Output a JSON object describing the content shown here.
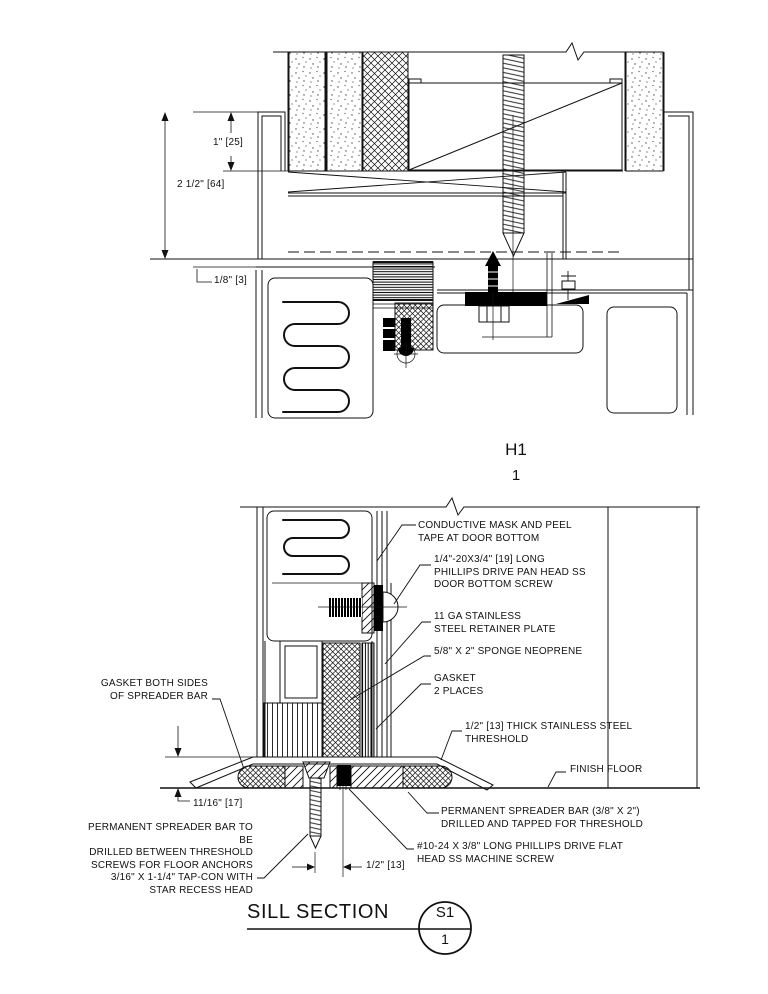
{
  "drawing": {
    "background": "#ffffff",
    "line_color": "#111111"
  },
  "head_detail": {
    "label": "H1",
    "number": "1",
    "dim_top": "1\" [25]",
    "dim_mid": "2 1/2\" [64]",
    "dim_bottom": "1/8\" [3]"
  },
  "sill_detail": {
    "title": "SILL SECTION",
    "bubble_detail": "S1",
    "bubble_sheet": "1",
    "dim_height": "11/16\" [17]",
    "dim_offset": "1/2\" [13]",
    "notes_right": [
      {
        "id": "conductive-mask",
        "text": "CONDUCTIVE MASK AND PEEL\nTAPE AT DOOR BOTTOM"
      },
      {
        "id": "door-bottom-screw",
        "text": "1/4\"-20X3/4\" [19] LONG\nPHILLIPS DRIVE PAN HEAD SS\nDOOR BOTTOM SCREW"
      },
      {
        "id": "retainer-plate",
        "text": "11 GA STAINLESS\nSTEEL RETAINER PLATE"
      },
      {
        "id": "sponge-neoprene",
        "text": "5/8\" X 2\" SPONGE NEOPRENE"
      },
      {
        "id": "gasket-2-places",
        "text": "GASKET\n2 PLACES"
      },
      {
        "id": "threshold",
        "text": "1/2\" [13] THICK STAINLESS STEEL\nTHRESHOLD"
      },
      {
        "id": "finish-floor",
        "text": "FINISH FLOOR"
      },
      {
        "id": "spreader-bar",
        "text": "PERMANENT SPREADER BAR (3/8\" X 2\")\nDRILLED AND TAPPED FOR THRESHOLD"
      },
      {
        "id": "machine-screw",
        "text": "#10-24 X 3/8\" LONG PHILLIPS DRIVE FLAT\nHEAD SS MACHINE SCREW"
      }
    ],
    "notes_left": [
      {
        "id": "gasket-both-sides",
        "text": "GASKET BOTH SIDES\nOF SPREADER BAR"
      },
      {
        "id": "tap-con",
        "text": "PERMANENT SPREADER BAR TO BE\nDRILLED BETWEEN THRESHOLD\nSCREWS FOR FLOOR ANCHORS\n3/16\" X 1-1/4\" TAP-CON WITH\nSTAR RECESS HEAD"
      }
    ]
  }
}
